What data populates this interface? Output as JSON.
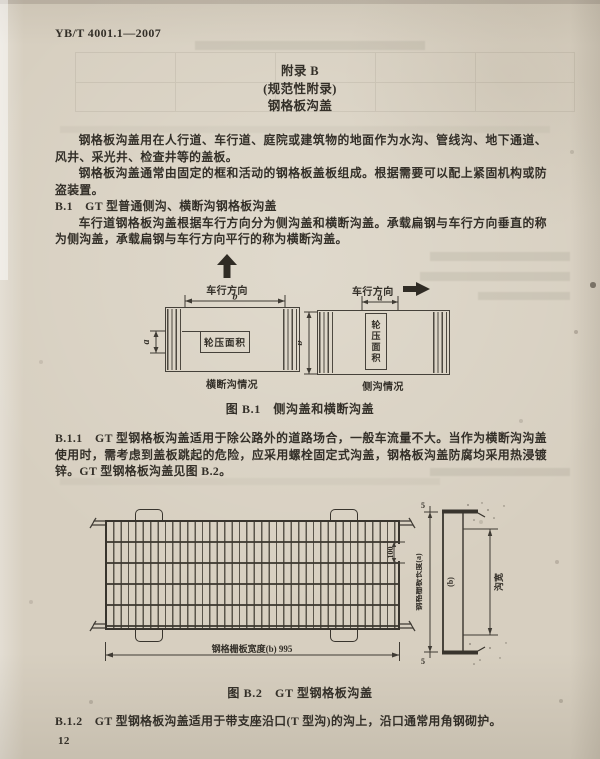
{
  "page": {
    "doc_number": "YB/T 4001.1—2007",
    "page_number": "12"
  },
  "colors": {
    "paper": "#d7cfc0",
    "ink": "#332f28",
    "drawing_line": "#45413a"
  },
  "appendix_title": {
    "line1": "附录 B",
    "line2": "(规范性附录)",
    "line3": "钢格板沟盖"
  },
  "paragraphs": {
    "intro1": "钢格板沟盖用在人行道、车行道、庭院或建筑物的地面作为水沟、管线沟、地下通道、风井、采光井、检查井等的盖板。",
    "intro2": "钢格板沟盖通常由固定的框和活动的钢格板盖板组成。根据需要可以配上紧固机构或防盗装置。",
    "b1_heading": "B.1　GT 型普通侧沟、横断沟钢格板沟盖",
    "b1_body": "车行道钢格板沟盖根据车行方向分为侧沟盖和横断沟盖。承载扁钢与车行方向垂直的称为侧沟盖，承载扁钢与车行方向平行的称为横断沟盖。",
    "b11": "B.1.1　GT 型钢格板沟盖适用于除公路外的道路场合，一般车流量不大。当作为横断沟沟盖使用时，需考虑到盖板跳起的危险，应采用螺栓固定式沟盖，钢格板沟盖防腐均采用热浸镀锌。GT 型钢格板沟盖见图 B.2。",
    "b12": "B.1.2　GT 型钢格板沟盖适用于带支座沿口(T 型沟)的沟上，沿口通常用角钢砌护。"
  },
  "figure_b1": {
    "caption": "图 B.1　侧沟盖和横断沟盖",
    "left": {
      "direction_label": "车行方向",
      "dim_top": "b",
      "dim_side": "a",
      "area_label": "轮压面积",
      "caption": "横断沟情况"
    },
    "right": {
      "direction_label": "车行方向",
      "dim_top": "a",
      "dim_side": "b",
      "area_label": "轮压面积",
      "caption": "侧沟情况"
    }
  },
  "figure_b2": {
    "caption": "图 B.2　GT 型钢格板沟盖",
    "plan": {
      "width_dim_label": "钢格栅板宽度(b) 995",
      "pitch_dim": "100"
    },
    "section": {
      "length_label": "钢格栅板长度(a)",
      "end_gap": "5",
      "grate_mark": "(b)",
      "trench_width_label": "沟宽"
    }
  }
}
